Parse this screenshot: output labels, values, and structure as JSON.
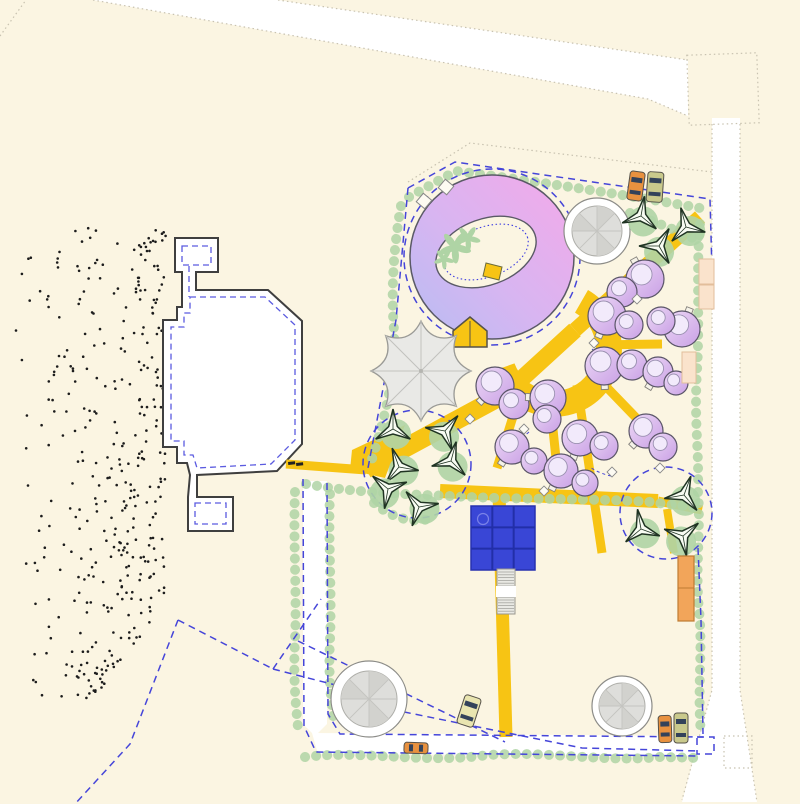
{
  "plan": {
    "canvas": {
      "w": 800,
      "h": 804,
      "bg": "#FBF5E2"
    },
    "palette": {
      "bg": "#FBF5E2",
      "yellow": "#F7C414",
      "hedge": "#AFD4A5",
      "dash": "#4545D9",
      "road_dot": "#C8C2B0",
      "outline": "#3F3F3F",
      "inner_dash": "#5B5BE0",
      "ring_from": "#B7BDF3",
      "ring_mid": "#D8B5F1",
      "ring_to": "#F4A9E9",
      "pod_from": "#EDD9F6",
      "pod_to": "#C9A0E5",
      "pod_inner": "#F2EAFB",
      "pool": "#3946D6",
      "pool_grid": "#222FA8",
      "peach": "#FAE3CC",
      "orange": "#F2A55A",
      "gray_tree": "#DEDEDB",
      "dot_color": "#1C1C1C",
      "tree_dark": "#1F3322",
      "car_window": "#33425A"
    },
    "roads": {
      "polys": [
        "93,0 278,0 688,60 688,116 648,99",
        "712,118 740,118 740,690 757,802 682,802 712,690"
      ],
      "junction": [
        688,
        54,
        70,
        70,
        -2
      ],
      "bump": [
        724,
        736,
        28,
        32
      ],
      "lines": [
        "278,0 688,60",
        "93,0 648,99 688,116",
        "712,124 712,690 682,800",
        "740,124 740,690 757,802",
        "0,36 26,0",
        "408,182 470,143 712,172"
      ]
    },
    "white_bands": [
      "303,481 327,481 327,724 315,736 303,724",
      "312,733 702,736 702,756 318,754"
    ],
    "building": {
      "outer": "M175,238 L218,238 L218,272 L196,272 L196,290 L268,290 L302,321 L302,444 L277,471 L197,475 L197,497 L233,497 L233,531 L188,531 L188,497 L190,475 L187,463 L177,463 L177,447 L163,447 L163,320 L177,320 L177,307 L182,307 L182,272 L175,272 Z",
      "inner": [
        "M182,246 L211,246 L211,265 L182,265 Z",
        "M190,297 L265,297 L295,325 L295,440 L271,464 L197,468 L193,455 L184,455 L184,441 L171,441 L171,327 L184,327 L184,313 L190,313 Z",
        "M195,503 L226,503 L226,524 L195,524 Z",
        "M189,266 L189,297"
      ]
    },
    "stipple": {
      "n_main": 300,
      "n_tail": 70
    },
    "yellow": {
      "segments": [
        {
          "p": "700,217 575,330",
          "w": 15
        },
        {
          "p": "575,330 505,394",
          "w": 17
        },
        {
          "p": "505,394 366,469",
          "w": 19
        },
        {
          "p": "596,345 662,344",
          "w": 9
        },
        {
          "p": "590,370 646,428",
          "w": 9
        },
        {
          "p": "577,385 602,553",
          "w": 9
        },
        {
          "p": "549,391 557,468",
          "w": 9
        },
        {
          "p": "524,381 497,468",
          "w": 9
        },
        {
          "p": "286,464 366,470",
          "w": 9
        },
        {
          "p": "499,492 506,737",
          "w": 13
        },
        {
          "p": "440,491 658,501",
          "w": 14
        },
        {
          "p": "658,501 702,510",
          "w": 9
        },
        {
          "p": "667,509 674,553",
          "w": 8
        }
      ],
      "plaza": "M588,290 A68,68 0 1 1 490,372 L514.5,363.4 A42,42 0 1 0 575,312.6 Z",
      "polys": [
        "352,450 405,425 385,478 350,470"
      ]
    },
    "hedges": {
      "paths": [
        "M401,206 C393,250 391,295 394,330 C397,375 382,428 371,462",
        "M409,197 L456,171 C540,182 620,194 700,208",
        "M700,224 C696,270 700,320 697,370 C694,420 699,450 698,486",
        "M306,484 C350,492 400,494 450,496 C520,500 590,498 652,502 C668,505 684,505 696,508",
        "M295,492 C293,540 297,590 295,640 C293,680 296,706 298,728",
        "M330,494 C328,540 332,590 330,640 C328,680 332,706 334,724",
        "M305,757 C360,750 420,763 480,756 C540,749 600,763 660,757 L700,758",
        "M698,492 C701,530 695,570 699,610 C703,650 697,690 701,734",
        "M630,213 C652,221 674,229 695,239",
        "M374,503 C392,518 412,524 433,518"
      ]
    },
    "dashed": {
      "polylines": [
        "408,188 455,162 710,199 713,307",
        "408,188 396,320 368,468",
        "698,548 701,620 703,734",
        "303,479 304,726 316,752 700,756",
        "327,483 328,714 340,734 703,737",
        "298,641 505,742",
        "345,700 582,748 700,751",
        "178,620 130,744 75,804",
        "178,620 273,669",
        "273,669 321,599",
        "273,669 351,689"
      ],
      "circles": [
        [
          417,
          464,
          54
        ],
        [
          666,
          513,
          46
        ],
        [
          492,
          257,
          88
        ]
      ],
      "rects": [
        [
          697,
          737,
          17,
          17
        ]
      ],
      "curves": [
        "M618,303 q-9,9 -11,17",
        "M592,349 q9,7 8,17",
        "M529,432 q-11,9 -15,19",
        "M611,476 q-13,-3 -21,-9",
        "M652,416 q-8,6 -14,5"
      ]
    },
    "ring": {
      "cx": 492,
      "cy": 257,
      "r": 82,
      "ellipse": {
        "cx": 486,
        "cy": 252,
        "rx": 52,
        "ry": 33,
        "rot": -20,
        "rx2": 44,
        "ry2": 25
      },
      "palms": [
        [
          455,
          247,
          1.1
        ],
        [
          468,
          238,
          0.85
        ],
        [
          444,
          259,
          0.7
        ]
      ],
      "marker": "486,263 502,267 499,280 483,276",
      "squares": [
        [
          424,
          201
        ],
        [
          446,
          187
        ]
      ],
      "house": {
        "pts": "453,331 470,317 487,331 487,347 453,347",
        "door": "470,321 470,347"
      }
    },
    "umbrella": {
      "path": "M471,371 Q447.6,382 456.4,406.4 Q432,397.6 421,421 Q410,397.6 385.6,406.4 Q394.4,382 371,371 Q394.4,360 385.6,335.6 Q410,344.4 421,321 Q432,344.4 456.4,335.6 Q447.6,360 471,371 Z",
      "cx": 421,
      "cy": 371,
      "tips": [
        [
          471,
          371
        ],
        [
          456.4,
          406.4
        ],
        [
          421,
          421
        ],
        [
          385.6,
          406.4
        ],
        [
          371,
          371
        ],
        [
          385.6,
          335.6
        ],
        [
          421,
          321
        ],
        [
          456.4,
          335.6
        ]
      ]
    },
    "gray_trees": [
      [
        597,
        231,
        33,
        25
      ],
      [
        369,
        699,
        38,
        28
      ],
      [
        622,
        706,
        30,
        23
      ]
    ],
    "tri_trees": [
      [
        641,
        216,
        10
      ],
      [
        686,
        227,
        -15
      ],
      [
        659,
        246,
        30
      ],
      [
        393,
        429,
        0
      ],
      [
        445,
        431,
        40
      ],
      [
        399,
        467,
        -20
      ],
      [
        451,
        461,
        15
      ],
      [
        388,
        489,
        70
      ],
      [
        419,
        507,
        -40
      ],
      [
        684,
        495,
        20
      ],
      [
        641,
        529,
        -10
      ],
      [
        683,
        536,
        50
      ]
    ],
    "pods": [
      [
        645,
        279,
        19,
        622,
        292,
        15
      ],
      [
        607,
        316,
        19,
        629,
        325,
        14
      ],
      [
        682,
        329,
        18,
        661,
        321,
        14
      ],
      [
        604,
        366,
        19,
        632,
        365,
        15
      ],
      [
        658,
        372,
        15,
        676,
        383,
        12
      ],
      [
        495,
        386,
        19,
        514,
        404,
        15
      ],
      [
        548,
        398,
        18,
        547,
        419,
        14
      ],
      [
        580,
        438,
        18,
        604,
        446,
        14
      ],
      [
        646,
        431,
        17,
        663,
        447,
        14
      ],
      [
        512,
        447,
        17,
        534,
        461,
        13
      ],
      [
        561,
        471,
        17,
        585,
        483,
        13
      ]
    ],
    "benches": [
      [
        637,
        299
      ],
      [
        594,
        343
      ],
      [
        524,
        429
      ],
      [
        612,
        472
      ],
      [
        660,
        468
      ],
      [
        544,
        491
      ],
      [
        470,
        419
      ]
    ],
    "pool": {
      "x": 471,
      "y": 506,
      "s": 64,
      "circle": [
        483,
        519,
        5.5
      ],
      "stairs": {
        "x": 497,
        "y": 569,
        "w": 18,
        "h": 45,
        "gap_y": 586,
        "gap_h": 11
      }
    },
    "peach_rects": [
      [
        699,
        259,
        15,
        25
      ],
      [
        699,
        285,
        15,
        24
      ],
      [
        682,
        352,
        14,
        31
      ]
    ],
    "container": {
      "x": 678,
      "y": 556,
      "w": 16,
      "h": 65,
      "split": 588
    },
    "cars": [
      [
        636,
        186,
        15,
        29,
        8,
        "#E8913F"
      ],
      [
        655,
        187,
        16,
        30,
        4,
        "#C9C98C"
      ],
      [
        469,
        711,
        17,
        30,
        18,
        "#E9E5B0"
      ],
      [
        416,
        748,
        24,
        11,
        2,
        "#E8913F"
      ],
      [
        665,
        729,
        13,
        27,
        -2,
        "#E8913F"
      ],
      [
        681,
        728,
        14,
        30,
        0,
        "#C9C98C"
      ]
    ],
    "gate_ticks": [
      [
        288,
        462
      ],
      [
        296,
        463
      ]
    ]
  }
}
